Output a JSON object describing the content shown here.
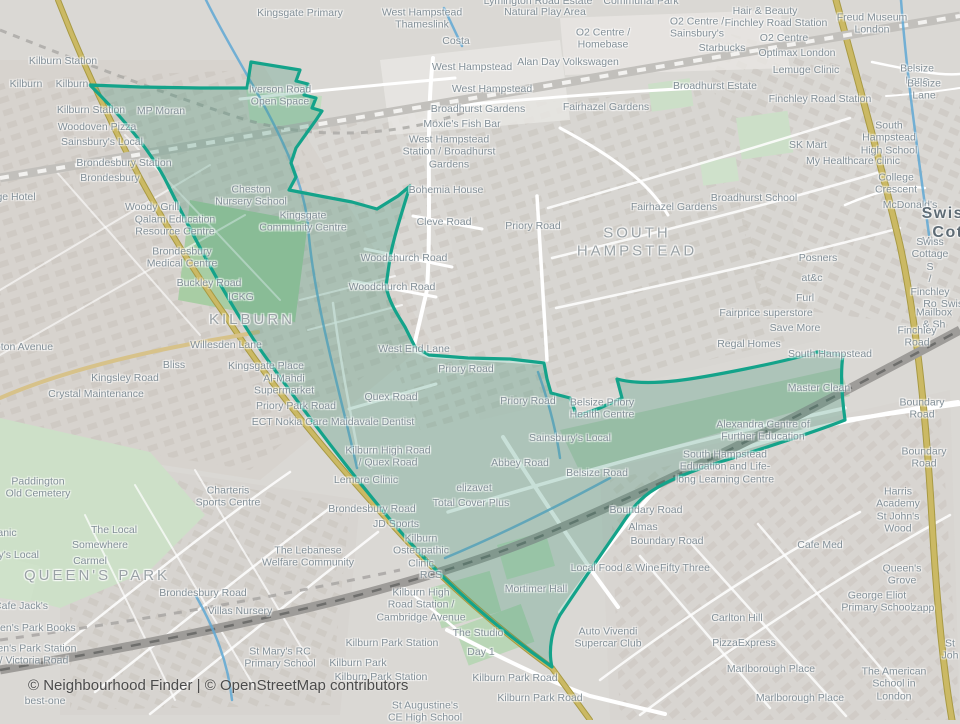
{
  "map": {
    "attribution": "© Neighbourhood Finder | © OpenStreetMap contributors",
    "theme": {
      "boundary_color": "#14a38a",
      "boundary_fill": "rgba(58,145,115,0.28)",
      "primary_road_color": "#cbb964",
      "cycleway_color": "#5fa8d3",
      "label_color": "#828f97"
    },
    "area_label_names": [
      "KILBURN",
      "SOUTH HAMPSTEAD",
      "QUEEN'S PARK",
      "Swiss Cottage (clipped)"
    ],
    "labels": [
      {
        "text": "Kilburn Station",
        "x": 63,
        "y": 61
      },
      {
        "text": "Kilburn",
        "x": 26,
        "y": 84
      },
      {
        "text": "Kilburn",
        "x": 72,
        "y": 84
      },
      {
        "text": "Kingsgate Primary",
        "x": 300,
        "y": 13
      },
      {
        "text": "West Hampstead\nThameslink",
        "x": 422,
        "y": 19
      },
      {
        "text": "Lymington Road Estate",
        "x": 538,
        "y": 1
      },
      {
        "text": "Natural Play Area",
        "x": 545,
        "y": 12
      },
      {
        "text": "Communal Park",
        "x": 641,
        "y": 1
      },
      {
        "text": "Hair & Beauty",
        "x": 765,
        "y": 11
      },
      {
        "text": "Costa",
        "x": 456,
        "y": 41
      },
      {
        "text": "O2 Centre /\nSainsbury's",
        "x": 697,
        "y": 28
      },
      {
        "text": "Finchley Road Station",
        "x": 776,
        "y": 23
      },
      {
        "text": "O2 Centre",
        "x": 784,
        "y": 38
      },
      {
        "text": "Freud Museum\nLondon",
        "x": 872,
        "y": 24
      },
      {
        "text": "Starbucks",
        "x": 722,
        "y": 48
      },
      {
        "text": "O2 Centre /\nHomebase",
        "x": 603,
        "y": 39
      },
      {
        "text": "Optimax London",
        "x": 797,
        "y": 53
      },
      {
        "text": "West Hampstead",
        "x": 472,
        "y": 67
      },
      {
        "text": "Alan Day Volkswagen",
        "x": 568,
        "y": 62
      },
      {
        "text": "Lemuge Clinic",
        "x": 806,
        "y": 70
      },
      {
        "text": "Belsize Lane",
        "x": 917,
        "y": 75
      },
      {
        "text": "Belsize Lane",
        "x": 924,
        "y": 90
      },
      {
        "text": "Broadhurst Estate",
        "x": 715,
        "y": 86
      },
      {
        "text": "West Hampstead",
        "x": 492,
        "y": 89
      },
      {
        "text": "Finchley Road Station",
        "x": 820,
        "y": 99
      },
      {
        "text": "Broadhurst Gardens",
        "x": 478,
        "y": 109
      },
      {
        "text": "Fairhazel Gardens",
        "x": 606,
        "y": 107
      },
      {
        "text": "Moxie's Fish Bar",
        "x": 462,
        "y": 124
      },
      {
        "text": "West Hampstead\nStation / Broadhurst\nGardens",
        "x": 449,
        "y": 152
      },
      {
        "text": "South Hampstead\nHigh School",
        "x": 889,
        "y": 138
      },
      {
        "text": "SK Mart",
        "x": 808,
        "y": 145
      },
      {
        "text": "My Healthcare clinic",
        "x": 853,
        "y": 161
      },
      {
        "text": "MP Moran",
        "x": 161,
        "y": 111
      },
      {
        "text": "Iverson Road\nOpen Space",
        "x": 280,
        "y": 96
      },
      {
        "text": "Kilburn Station",
        "x": 91,
        "y": 110
      },
      {
        "text": "Woodoven Pizza",
        "x": 97,
        "y": 127
      },
      {
        "text": "Sainsbury's Local",
        "x": 102,
        "y": 142
      },
      {
        "text": "Brondesbury Station",
        "x": 124,
        "y": 163
      },
      {
        "text": "Brondesbury",
        "x": 110,
        "y": 178
      },
      {
        "text": "ge Hotel",
        "x": 16,
        "y": 197
      },
      {
        "text": "Woody Grill",
        "x": 152,
        "y": 207
      },
      {
        "text": "Cheston\nNursery School",
        "x": 251,
        "y": 196
      },
      {
        "text": "Qalam Education\nResource Centre",
        "x": 175,
        "y": 226
      },
      {
        "text": "Kingsgate\nCommunity Centre",
        "x": 303,
        "y": 222
      },
      {
        "text": "Bohemia House",
        "x": 446,
        "y": 190
      },
      {
        "text": "Cleve Road",
        "x": 444,
        "y": 222
      },
      {
        "text": "Priory Road",
        "x": 533,
        "y": 226
      },
      {
        "text": "Fairhazel Gardens",
        "x": 674,
        "y": 207
      },
      {
        "text": "SOUTH\nHAMPSTEAD",
        "x": 637,
        "y": 242,
        "type": "area"
      },
      {
        "text": "Broadhurst School",
        "x": 754,
        "y": 198
      },
      {
        "text": "College Crescent",
        "x": 896,
        "y": 184
      },
      {
        "text": "McDonald's",
        "x": 910,
        "y": 205
      },
      {
        "text": "Swiss Cot",
        "x": 948,
        "y": 224,
        "type": "big"
      },
      {
        "text": "Brondesbury\nMedical Centre",
        "x": 182,
        "y": 258
      },
      {
        "text": "Woodchurch Road",
        "x": 404,
        "y": 258
      },
      {
        "text": "Mia",
        "x": 930,
        "y": 241
      },
      {
        "text": "Posners",
        "x": 818,
        "y": 258
      },
      {
        "text": "Swiss Cottage S\n/ Finchley Ro",
        "x": 930,
        "y": 273
      },
      {
        "text": "at&c",
        "x": 812,
        "y": 278
      },
      {
        "text": "Buckley Road",
        "x": 209,
        "y": 283
      },
      {
        "text": "Woodchurch Road",
        "x": 392,
        "y": 287
      },
      {
        "text": "ICKG",
        "x": 241,
        "y": 297
      },
      {
        "text": "Furl",
        "x": 805,
        "y": 298
      },
      {
        "text": "Swis",
        "x": 952,
        "y": 304
      },
      {
        "text": "KILBURN",
        "x": 252,
        "y": 320,
        "type": "area"
      },
      {
        "text": "Fairprice superstore",
        "x": 766,
        "y": 313
      },
      {
        "text": "Mailbox & Sh",
        "x": 934,
        "y": 319
      },
      {
        "text": "Save More",
        "x": 795,
        "y": 328
      },
      {
        "text": "Willesden Lane",
        "x": 226,
        "y": 345
      },
      {
        "text": "Finchley Road",
        "x": 917,
        "y": 337
      },
      {
        "text": "Regal Homes",
        "x": 749,
        "y": 344
      },
      {
        "text": "oton Avenue",
        "x": 24,
        "y": 347
      },
      {
        "text": "West End Lane",
        "x": 414,
        "y": 349
      },
      {
        "text": "South Hampstead",
        "x": 830,
        "y": 354
      },
      {
        "text": "Bliss",
        "x": 174,
        "y": 365
      },
      {
        "text": "Kingsgate Place",
        "x": 266,
        "y": 366
      },
      {
        "text": "Priory Road",
        "x": 466,
        "y": 369
      },
      {
        "text": "Kingsley Road",
        "x": 125,
        "y": 378
      },
      {
        "text": "Al-Mahdi\nSupermarket",
        "x": 284,
        "y": 385
      },
      {
        "text": "Master Clean",
        "x": 819,
        "y": 388
      },
      {
        "text": "Crystal Maintenance",
        "x": 96,
        "y": 394
      },
      {
        "text": "Quex Road",
        "x": 391,
        "y": 397
      },
      {
        "text": "Priory Road",
        "x": 528,
        "y": 401
      },
      {
        "text": "Priory Park Road",
        "x": 296,
        "y": 406
      },
      {
        "text": "Belsize Priory\nHealth Centre",
        "x": 602,
        "y": 409
      },
      {
        "text": "Boundary Road",
        "x": 922,
        "y": 409
      },
      {
        "text": "ECT Nokia Care Maidavale Dentist",
        "x": 333,
        "y": 422
      },
      {
        "text": "Alexandra Centre of\nFurther Education",
        "x": 763,
        "y": 431
      },
      {
        "text": "Sainsbury's Local",
        "x": 570,
        "y": 438
      },
      {
        "text": "Kilburn High Road\n/ Quex Road",
        "x": 388,
        "y": 457
      },
      {
        "text": "Boundary Road",
        "x": 924,
        "y": 458
      },
      {
        "text": "Abbey Road",
        "x": 520,
        "y": 463
      },
      {
        "text": "South Hampstead\nEducation and Life-\nlong Learning Centre",
        "x": 725,
        "y": 467
      },
      {
        "text": "Belsize Road",
        "x": 597,
        "y": 473
      },
      {
        "text": "Lemore Clinic",
        "x": 366,
        "y": 480
      },
      {
        "text": "elizavet",
        "x": 474,
        "y": 488
      },
      {
        "text": "Paddington\nOld Cemetery",
        "x": 38,
        "y": 488
      },
      {
        "text": "Charteris\nSports Centre",
        "x": 228,
        "y": 497
      },
      {
        "text": "Total Cover Plus",
        "x": 471,
        "y": 503
      },
      {
        "text": "Harris Academy\nSt John's Wood",
        "x": 898,
        "y": 510
      },
      {
        "text": "Brondesbury Road",
        "x": 372,
        "y": 509
      },
      {
        "text": "Boundary Road",
        "x": 646,
        "y": 510
      },
      {
        "text": "JD Sports",
        "x": 396,
        "y": 524
      },
      {
        "text": "Almas",
        "x": 643,
        "y": 527
      },
      {
        "text": "The Local",
        "x": 114,
        "y": 530
      },
      {
        "text": "anic",
        "x": 7,
        "y": 533
      },
      {
        "text": "Boundary Road",
        "x": 667,
        "y": 541
      },
      {
        "text": "Cafe Med",
        "x": 820,
        "y": 545
      },
      {
        "text": "Somewhere",
        "x": 100,
        "y": 545
      },
      {
        "text": "Kilburn\nOsteopathic\nClinic",
        "x": 421,
        "y": 551
      },
      {
        "text": "ry's Local",
        "x": 17,
        "y": 555
      },
      {
        "text": "The Lebanese\nWelfare Community",
        "x": 308,
        "y": 557
      },
      {
        "text": "Carmel",
        "x": 90,
        "y": 561
      },
      {
        "text": "Local Food & Wine",
        "x": 615,
        "y": 568
      },
      {
        "text": "Fifty Three",
        "x": 685,
        "y": 568
      },
      {
        "text": "RCS",
        "x": 431,
        "y": 575
      },
      {
        "text": "QUEEN'S PARK",
        "x": 97,
        "y": 576,
        "type": "area"
      },
      {
        "text": "Queen's Grove",
        "x": 902,
        "y": 575
      },
      {
        "text": "Mortimer Hall",
        "x": 536,
        "y": 589
      },
      {
        "text": "Brondesbury Road",
        "x": 203,
        "y": 593
      },
      {
        "text": "Kilburn High\nRoad Station /\nCambridge Avenue",
        "x": 421,
        "y": 605
      },
      {
        "text": "George Eliot\nPrimary School",
        "x": 877,
        "y": 602
      },
      {
        "text": "zapp",
        "x": 923,
        "y": 608
      },
      {
        "text": "Cafe Jack's",
        "x": 21,
        "y": 606
      },
      {
        "text": "Villas Nursery",
        "x": 240,
        "y": 611
      },
      {
        "text": "Carlton Hill",
        "x": 737,
        "y": 618
      },
      {
        "text": "ueen's Park Books",
        "x": 32,
        "y": 628
      },
      {
        "text": "The Studio",
        "x": 478,
        "y": 633
      },
      {
        "text": "Auto Vivendi\nSupercar Club",
        "x": 608,
        "y": 638
      },
      {
        "text": "Kilburn Park Station",
        "x": 392,
        "y": 643
      },
      {
        "text": "PizzaExpress",
        "x": 744,
        "y": 643
      },
      {
        "text": "St Joh",
        "x": 950,
        "y": 650
      },
      {
        "text": "Day 1",
        "x": 481,
        "y": 652
      },
      {
        "text": "een's Park Station\n/ Victoria Road",
        "x": 34,
        "y": 655
      },
      {
        "text": "St Mary's RC\nPrimary School",
        "x": 280,
        "y": 658
      },
      {
        "text": "Kilburn Park",
        "x": 358,
        "y": 663
      },
      {
        "text": "Marlborough Place",
        "x": 771,
        "y": 669
      },
      {
        "text": "Kilburn Park Station",
        "x": 381,
        "y": 677
      },
      {
        "text": "Kilburn Park Road",
        "x": 515,
        "y": 678
      },
      {
        "text": "The American\nSchool in London",
        "x": 894,
        "y": 684
      },
      {
        "text": "best-one",
        "x": 45,
        "y": 701
      },
      {
        "text": "Kilburn Park Road",
        "x": 540,
        "y": 698
      },
      {
        "text": "Marlborough Place",
        "x": 800,
        "y": 698
      },
      {
        "text": "St Augustine's\nCE High School",
        "x": 425,
        "y": 712
      }
    ]
  }
}
